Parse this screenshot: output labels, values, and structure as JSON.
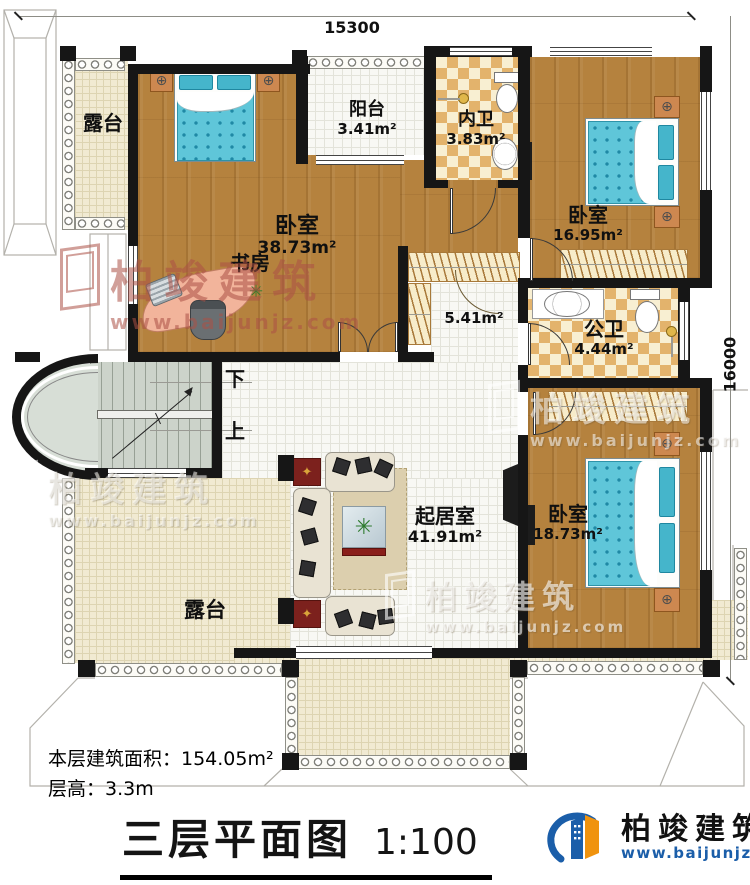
{
  "dimensions": {
    "top": "15300",
    "right": "16000"
  },
  "rooms": {
    "terrace_top": {
      "label": "露台"
    },
    "master_bedroom": {
      "label": "卧室",
      "area": "38.73m²"
    },
    "study": {
      "label": "书房"
    },
    "balcony": {
      "label": "阳台",
      "area": "3.41m²"
    },
    "ensuite_bath": {
      "label": "内卫",
      "area": "3.83m²"
    },
    "bedroom_top_right": {
      "label": "卧室",
      "area": "16.95m²"
    },
    "hallway": {
      "area": "5.41m²"
    },
    "shared_bath": {
      "label": "公卫",
      "area": "4.44m²"
    },
    "living_room": {
      "label": "起居室",
      "area": "41.91m²"
    },
    "bedroom_bottom_right": {
      "label": "卧室",
      "area": "18.73m²"
    },
    "terrace_bottom": {
      "label": "露台"
    },
    "stairs": {
      "down_label": "下",
      "up_label": "上"
    }
  },
  "footer": {
    "floor_area_note": "本层建筑面积：154.05m²",
    "floor_height_note": "层高：3.3m",
    "title": "三层平面图",
    "scale": "1:100"
  },
  "brand": {
    "company": "柏竣建筑",
    "website": "www.baijunjz.com"
  },
  "watermark": {
    "company": "柏竣建筑",
    "website": "www.baijunjz.com"
  },
  "icons": {
    "lamp": "⊕",
    "star": "✦",
    "plant": "✳"
  },
  "colors": {
    "wall": "#161616",
    "wood_floor": "#b5823e",
    "tile_cream": "#f1ead2",
    "checker_tan": "#e3b36c",
    "bed_teal": "#5fc6d9",
    "brand_blue": "#1b5ea9",
    "brand_orange": "#f0930e"
  }
}
